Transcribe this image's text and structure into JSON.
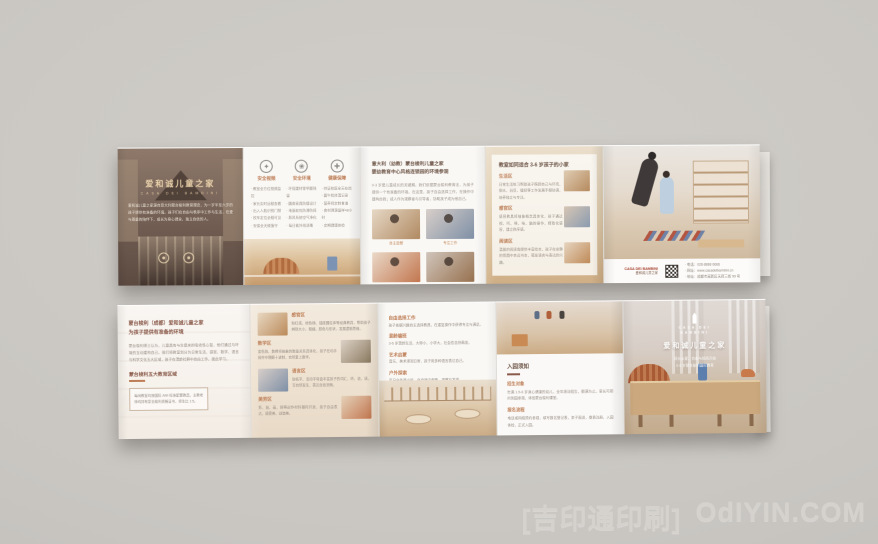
{
  "colors": {
    "background": "#c9c6c2",
    "accent_orange": "#bd7d55",
    "heading_brown": "#6d5547",
    "deep_red": "#a8402f",
    "body_gray": "#9a9188",
    "wood_tan": "#cba87d"
  },
  "watermark": {
    "cn": "[吉印通印刷]",
    "site": "OdIYIN.COM"
  },
  "top": {
    "p1": {
      "title": "爱和诚儿童之家",
      "subtitle": "CASA DEI BAMBINI",
      "body": "爱和诚儿童之家源自意大利蒙台梭利教育理念，为一岁半至六岁的孩子提供有准备的环境。孩子们在自由与秩序中工作与生活，在爱与尊重的陪伴下，成长为身心健全、独立自信的人。"
    },
    "p2": {
      "cols": [
        {
          "glyph": "✦",
          "title": "安全视频",
          "items": "· 教室全方位视频监控\n· 家长实时远程查看\n· 出入人脸识别门禁\n· 校车定位全程可见\n· 安保全天候值守"
        },
        {
          "glyph": "❀",
          "title": "安全环境",
          "items": "· 环保建材零甲醛残留\n· 圆角家具防撞设计\n· 地面软包防滑防摔\n· 新风系统空气净化\n· 每日紫外线消毒"
        },
        {
          "glyph": "✚",
          "title": "健康保障",
          "items": "· 持证校医全天在岗\n· 晨午检体温记录\n· 营养师定制食谱\n· 食材溯源留样48小时\n· 定期健康体检"
        }
      ]
    },
    "p3": {
      "heading1": "意大利（幼教）蒙台梭利儿童之家",
      "heading2": "婴幼教育中心风格连锁园的环境参观",
      "body": "0-3 岁是儿童成长的关键期。我们依据蒙台梭利教育法，为孩子提供一个有准备的环境。在这里，孩子自由选择工作，在操作中建构自我；成人作为观察者与引导者，协助孩子成为他自己。",
      "photos": [
        {
          "caption": "自主进餐"
        },
        {
          "caption": "专注工作"
        },
        {
          "caption": "动手操作"
        },
        {
          "caption": "混龄社交"
        }
      ]
    },
    "p4": {
      "heading": "教室如同适合 3-6 岁孩子的小家",
      "sections": [
        {
          "title": "生活区",
          "body": "日常生活练习帮助孩子照顾自己与环境，倒水、舀豆、缝纫等工作发展手眼协调，培养独立与专注。"
        },
        {
          "title": "感官区",
          "body": "感官教具将抽象概念具体化，孩子通过视、听、嗅、味、触的操作，精致化感官，建立秩序感。"
        },
        {
          "title": "阅读区",
          "body": "温馨的阅读角提供丰富绘本，孩子在安静的氛围中亲近书本，萌发语言与表达的兴趣。"
        }
      ]
    },
    "p5": {
      "logo_en": "CASA DEI BAMBINI",
      "logo_cn": "爱和诚儿童之家",
      "contacts": "· 电话：028-8888 6666\n· 网址：www.casadeibambini.cn\n· 地址：成都市高新区天府三街 99 号"
    }
  },
  "bottom": {
    "p1": {
      "heading1": "蒙台梭利（成都）爱和诚儿童之家",
      "heading2": "为孩子提供有准备的环境",
      "body": "蒙台梭利博士认为，儿童具有与生俱来的吸收性心智，他们通过与环境的互动建构自己。我们将教室划分为日常生活、感官、数学、语言与科学文化五大区域，孩子在混龄社群中自由工作、彼此学习。",
      "subhead": "蒙台梭利五大教育区域",
      "note": "每间教室均按国际 AMI 标准配置教具，主教老师均持有蒙台梭利资格证书，师生比 1:5。"
    },
    "p2": {
      "rows": [
        {
          "title": "感官区",
          "body": "粉红塔、棕色梯、插座圆柱体等经典教具，帮助孩子辨别大小、粗细、颜色与形状，发展逻辑思维。"
        },
        {
          "title": "数学区",
          "body": "金色珠、数棒将抽象的数量关系具体化，孩子在动手操作中理解十进制，自然爱上数学。"
        },
        {
          "title": "语言区",
          "body": "砂纸字、活动字母盒丰富孩子的词汇，听、说、读、写自然发生，表达自信流畅。"
        },
        {
          "title": "美劳区",
          "body": "剪、贴、画、捏等创作材料随时开放，孩子自由表达，感受美、创造美。"
        }
      ]
    },
    "p3": {
      "sections": [
        {
          "title": "自由选择工作",
          "body": "孩子依据兴趣自主选择教具，在重复操作中获得专注与满足。"
        },
        {
          "title": "混龄编班",
          "body": "3-6 岁混龄生活，大带小、小学大，社会性自然萌发。"
        },
        {
          "title": "艺术启蒙",
          "body": "音乐、美术浸润日常，孩子用多种语言表达自己。"
        },
        {
          "title": "户外探索",
          "body": "每日户外两小时，在自然中奔跑、观察与发现。"
        }
      ]
    },
    "p4": {
      "heading": "入园须知",
      "sections": [
        {
          "title": "招生对象",
          "body": "年满 1.5-6 岁身心健康的幼儿，全年滚动招生，额满为止。家长可预约到园参观，体验蒙台梭利课堂。"
        },
        {
          "title": "报名流程",
          "body": "电话或网络预约参观，填写报名登记表，亲子面谈，缴费注册，入园体检，正式入园。"
        }
      ]
    },
    "p5": {
      "logo_en1": "CASA DEI",
      "logo_en2": "BAMBINI",
      "title": "爱和诚儿童之家",
      "line1": "成长从爱、自由与规则开始",
      "line2": "0-6 岁蒙台梭利国际教育"
    }
  }
}
